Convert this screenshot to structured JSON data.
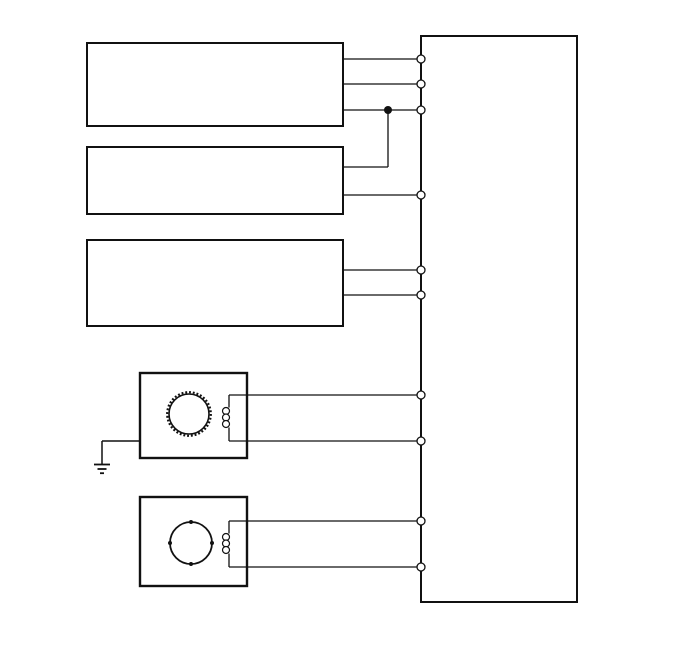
{
  "canvas": {
    "width": 688,
    "height": 658,
    "background_color": "#ffffff",
    "line_color": "#111111"
  },
  "schematic": {
    "blocks": [
      {
        "name": "module-block-1",
        "x": 87,
        "y": 43,
        "w": 256,
        "h": 83,
        "stroke": 2
      },
      {
        "name": "module-block-2",
        "x": 87,
        "y": 147,
        "w": 256,
        "h": 67,
        "stroke": 2
      },
      {
        "name": "module-block-3",
        "x": 87,
        "y": 240,
        "w": 256,
        "h": 86,
        "stroke": 2
      },
      {
        "name": "controller-block",
        "x": 421,
        "y": 36,
        "w": 156,
        "h": 566,
        "stroke": 2
      },
      {
        "name": "motor-a-housing",
        "x": 140,
        "y": 373,
        "w": 107,
        "h": 85,
        "stroke": 2.4
      },
      {
        "name": "motor-b-housing",
        "x": 140,
        "y": 497,
        "w": 107,
        "h": 89,
        "stroke": 2.4
      }
    ],
    "wires": [
      {
        "name": "wire-block1-pin1",
        "x1": 343,
        "y1": 59,
        "x2": 421,
        "y2": 59
      },
      {
        "name": "wire-block1-pin2",
        "x1": 343,
        "y1": 84,
        "x2": 421,
        "y2": 84
      },
      {
        "name": "wire-block1-pin3",
        "x1": 343,
        "y1": 110,
        "x2": 421,
        "y2": 110
      },
      {
        "name": "wire-junction-drop",
        "x1": 388,
        "y1": 110,
        "x2": 388,
        "y2": 167
      },
      {
        "name": "wire-block2-pin1",
        "x1": 343,
        "y1": 167,
        "x2": 388,
        "y2": 167
      },
      {
        "name": "wire-block2-pin2",
        "x1": 343,
        "y1": 195,
        "x2": 421,
        "y2": 195
      },
      {
        "name": "wire-block3-pin1",
        "x1": 343,
        "y1": 270,
        "x2": 421,
        "y2": 270
      },
      {
        "name": "wire-block3-pin2",
        "x1": 343,
        "y1": 295,
        "x2": 421,
        "y2": 295
      },
      {
        "name": "wire-motor-a-top",
        "x1": 229,
        "y1": 395,
        "x2": 421,
        "y2": 395
      },
      {
        "name": "wire-motor-a-bottom",
        "x1": 229,
        "y1": 441,
        "x2": 421,
        "y2": 441
      },
      {
        "name": "wire-motor-b-top",
        "x1": 229,
        "y1": 521,
        "x2": 421,
        "y2": 521
      },
      {
        "name": "wire-motor-b-bottom",
        "x1": 229,
        "y1": 567,
        "x2": 421,
        "y2": 567
      }
    ],
    "wire_stroke": 1.3,
    "terminals": [
      {
        "name": "terminal-1",
        "cx": 421,
        "cy": 59
      },
      {
        "name": "terminal-2",
        "cx": 421,
        "cy": 84
      },
      {
        "name": "terminal-3",
        "cx": 421,
        "cy": 110
      },
      {
        "name": "terminal-4",
        "cx": 421,
        "cy": 195
      },
      {
        "name": "terminal-5",
        "cx": 421,
        "cy": 270
      },
      {
        "name": "terminal-6",
        "cx": 421,
        "cy": 295
      },
      {
        "name": "terminal-7",
        "cx": 421,
        "cy": 395
      },
      {
        "name": "terminal-8",
        "cx": 421,
        "cy": 441
      },
      {
        "name": "terminal-9",
        "cx": 421,
        "cy": 521
      },
      {
        "name": "terminal-10",
        "cx": 421,
        "cy": 567
      }
    ],
    "terminal_r": 4,
    "junction": {
      "name": "junction-dot",
      "cx": 388,
      "cy": 110,
      "r": 4
    },
    "motor_a": {
      "rotor": {
        "name": "motor-a-toothed-rotor",
        "cx": 189,
        "cy": 414,
        "r": 20,
        "teeth_r": 21.8,
        "teeth_dash": "1.9 1.9",
        "teeth_stroke": 2.2
      },
      "coil": {
        "name": "motor-a-coil",
        "x": 229,
        "top": 395,
        "bottom": 441,
        "loop_cx": 226,
        "loop_r": 3.5,
        "loops": [
          411,
          417.5,
          424
        ]
      }
    },
    "motor_b": {
      "rotor": {
        "name": "motor-b-rotor",
        "cx": 191,
        "cy": 543,
        "r": 21,
        "pole_r": 2,
        "poles": [
          [
            191,
            522
          ],
          [
            212,
            543
          ],
          [
            191,
            564
          ],
          [
            170,
            543
          ]
        ]
      },
      "coil": {
        "name": "motor-b-coil",
        "x": 229,
        "top": 521,
        "bottom": 567,
        "loop_cx": 226,
        "loop_r": 3.5,
        "loops": [
          537,
          543.5,
          550
        ]
      }
    },
    "ground": {
      "name": "earth-ground-symbol",
      "feed": {
        "x1": 102,
        "y1": 441,
        "x2": 140,
        "y2": 441
      },
      "stem": {
        "x": 102,
        "y1": 441,
        "y2": 464
      },
      "bars": [
        {
          "y": 464.5,
          "x1": 94,
          "x2": 110
        },
        {
          "y": 469,
          "x1": 97.5,
          "x2": 106.5
        },
        {
          "y": 473.2,
          "x1": 100,
          "x2": 104
        }
      ],
      "bar_stroke": 1.8
    }
  }
}
